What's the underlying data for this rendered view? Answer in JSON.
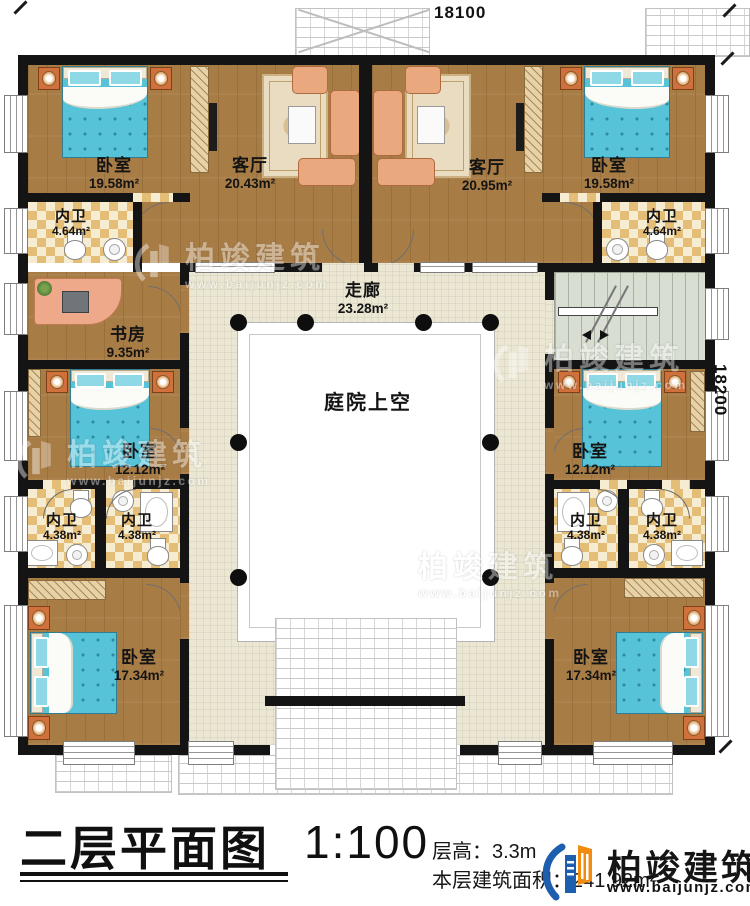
{
  "dimensions": {
    "top": "18100",
    "right": "18200"
  },
  "rooms": [
    {
      "id": "bedroom-top-left",
      "name": "卧室",
      "area": "19.58m²"
    },
    {
      "id": "living-top-left",
      "name": "客厅",
      "area": "20.43m²"
    },
    {
      "id": "living-top-right",
      "name": "客厅",
      "area": "20.95m²"
    },
    {
      "id": "bedroom-top-right",
      "name": "卧室",
      "area": "19.58m²"
    },
    {
      "id": "bath-top-left",
      "name": "内卫",
      "area": "4.64m²"
    },
    {
      "id": "bath-top-right",
      "name": "内卫",
      "area": "4.64m²"
    },
    {
      "id": "study",
      "name": "书房",
      "area": "9.35m²"
    },
    {
      "id": "bedroom-mid-left",
      "name": "卧室",
      "area": "12.12m²"
    },
    {
      "id": "bath-left-1",
      "name": "内卫",
      "area": "4.38m²"
    },
    {
      "id": "bath-left-2",
      "name": "内卫",
      "area": "4.38m²"
    },
    {
      "id": "bedroom-bottom-left",
      "name": "卧室",
      "area": "17.34m²"
    },
    {
      "id": "bedroom-mid-right",
      "name": "卧室",
      "area": "12.12m²"
    },
    {
      "id": "bath-right-1",
      "name": "内卫",
      "area": "4.38m²"
    },
    {
      "id": "bath-right-2",
      "name": "内卫",
      "area": "4.38m²"
    },
    {
      "id": "bedroom-bottom-right",
      "name": "卧室",
      "area": "17.34m²"
    },
    {
      "id": "corridor",
      "name": "走廊",
      "area": "23.28m²"
    },
    {
      "id": "courtyard",
      "name": "庭院上空",
      "area": ""
    }
  ],
  "watermark": {
    "name": "柏竣建筑",
    "url": "www.baijunjz.com"
  },
  "title_block": {
    "title": "二层平面图",
    "scale": "1:100",
    "floor_height": "层高：3.3m",
    "floor_area": "本层建筑面积：241.92m²",
    "brand_name": "柏竣建筑",
    "brand_url": "www.baijunjz.com"
  },
  "colors": {
    "brand_blue": "#1d5fae",
    "brand_orange": "#f18c10",
    "wall": "#141414"
  }
}
